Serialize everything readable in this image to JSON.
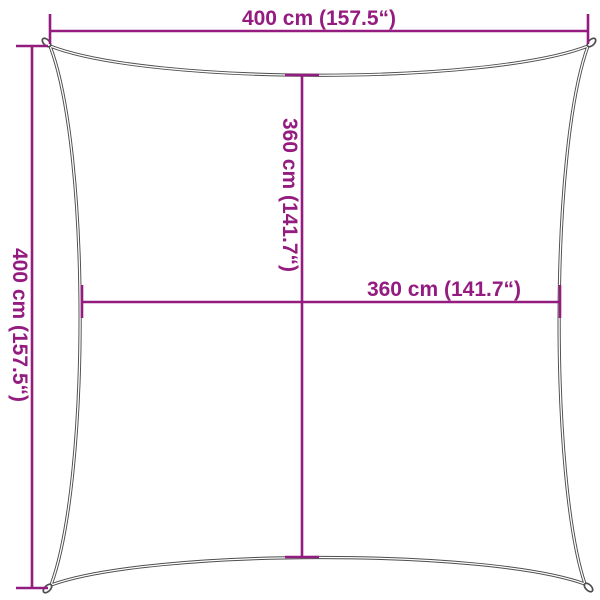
{
  "diagram": {
    "subject": "square shade sail dimension drawing",
    "dimensions": {
      "top_width": "400 cm (157.5“)",
      "left_height": "400 cm (157.5“)",
      "inner_height": "360 cm (141.7“)",
      "inner_width": "360 cm (141.7“)"
    },
    "values": {
      "outer_width_cm": 400,
      "outer_width_in": 157.5,
      "outer_height_cm": 400,
      "outer_height_in": 157.5,
      "inner_width_cm": 360,
      "inner_width_in": 141.7,
      "inner_height_cm": 360,
      "inner_height_in": 141.7
    },
    "colors": {
      "dimension": "#941b80",
      "outline": "#4d4d4d",
      "background": "#ffffff"
    }
  }
}
